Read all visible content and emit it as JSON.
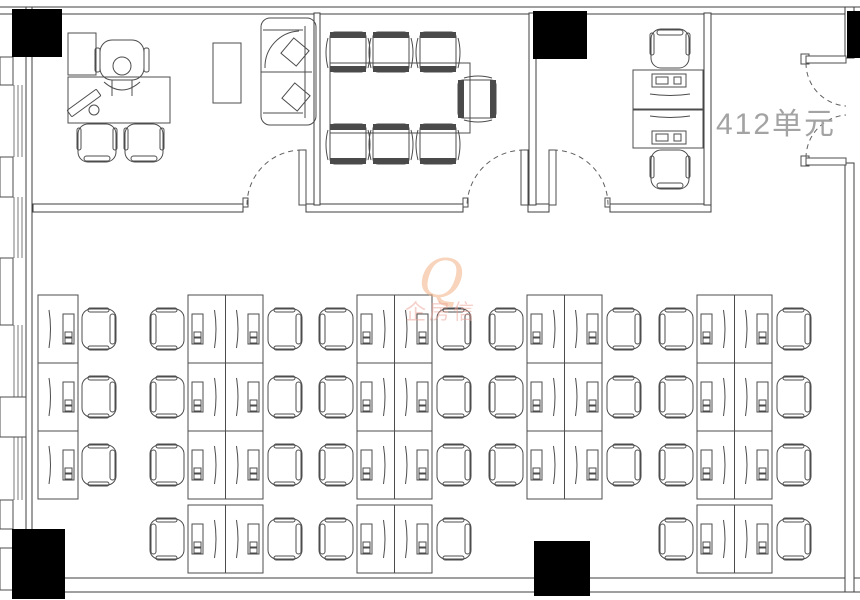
{
  "unit_label": "412单元",
  "watermark": {
    "logo_char": "Q",
    "text": "企房信"
  },
  "colors": {
    "line": "#4c4c4c",
    "wall_line": "#3f3f3f",
    "column_fill": "#000000",
    "chair_back_fill": "#4a4a4a",
    "unit_label_color": "#a3a3a3",
    "watermark_orange": "#f2b285",
    "watermark_pink": "#eda094"
  },
  "meeting_room": {
    "chairs_top": 3,
    "chairs_bottom": 3,
    "chairs_end": 1
  },
  "workstations": {
    "desk_height": 68,
    "single_desk_width": 40,
    "double_desk_width": 75,
    "groups": [
      {
        "id": "column-1",
        "type": "single",
        "x": 38,
        "rows": [
          295,
          363,
          431
        ]
      },
      {
        "id": "column-2",
        "type": "double",
        "x": 188,
        "rows": [
          295,
          363,
          431,
          505
        ]
      },
      {
        "id": "column-3",
        "type": "double",
        "x": 357,
        "rows": [
          295,
          363,
          431,
          505
        ]
      },
      {
        "id": "column-4",
        "type": "double",
        "x": 527,
        "rows": [
          295,
          363,
          431
        ]
      },
      {
        "id": "column-5",
        "type": "double",
        "x": 697,
        "rows": [
          295,
          363,
          431,
          505
        ]
      }
    ]
  }
}
